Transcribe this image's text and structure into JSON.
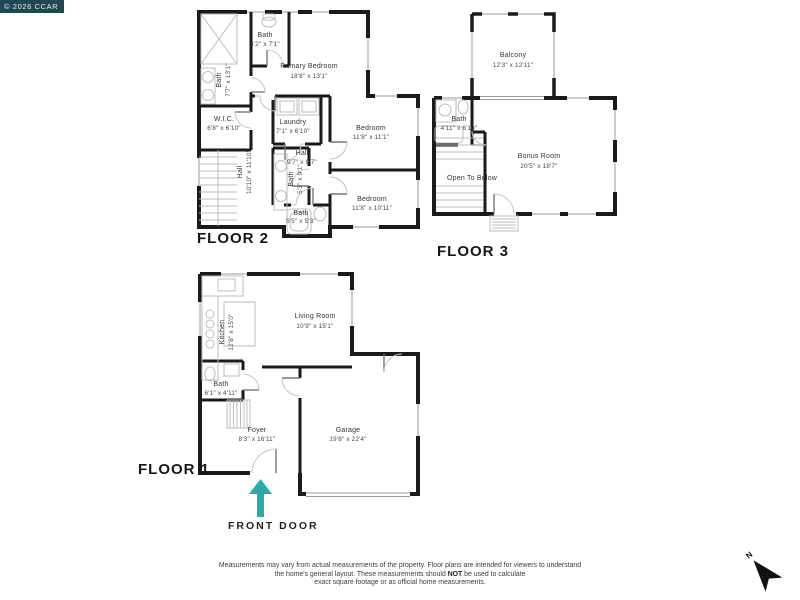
{
  "copyright": "© 2026 CCAR",
  "front_door_label": "FRONT DOOR",
  "north_label": "N",
  "colors": {
    "accent_teal": "#2aa9ae",
    "wall": "#1a1a1a",
    "copyright_bg": "#1d4752"
  },
  "floor2": {
    "label": "FLOOR 2",
    "primary_name": "Primary Bedroom",
    "primary_dims": "18'8\" x 13'1\"",
    "bath_top_name": "Bath",
    "bath_top_dims": "4'2\" x 7'1\"",
    "bath_left_name": "Bath",
    "bath_left_dims": "7'7\" x 13'1\"",
    "wic_name": "W.I.C.",
    "wic_dims": "6'8\" x 6'10\"",
    "laundry_name": "Laundry",
    "laundry_dims": "7'1\" x 6'10\"",
    "hall_left_name": "Hall",
    "hall_left_dims": "10'10\" x 11'10\"",
    "hall_name": "Hall",
    "hall_dims": "9'7\" x 9'7\"",
    "bedroom1_name": "Bedroom",
    "bedroom1_dims": "11'8\" x 11'1\"",
    "bedroom2_name": "Bedroom",
    "bedroom2_dims": "11'8\" x 10'11\"",
    "bath_mid_name": "Bath",
    "bath_mid_dims": "5'3\" x 9'1\"",
    "bath_bottom_name": "Bath",
    "bath_bottom_dims": "5'5\" x 5'3\""
  },
  "floor3": {
    "label": "FLOOR 3",
    "balcony_name": "Balcony",
    "balcony_dims": "12'3\" x 12'11\"",
    "bath_name": "Bath",
    "bath_dims": "4'11\" x 6'10\"",
    "bonus_name": "Bonus Room",
    "bonus_dims": "20'5\" x 18'7\"",
    "open_below": "Open To Below"
  },
  "floor1": {
    "label": "FLOOR 1",
    "kitchen_name": "Kitchen",
    "kitchen_dims": "12'8\" x 15'0\"",
    "living_name": "Living Room",
    "living_dims": "10'9\" x 15'1\"",
    "bath_name": "Bath",
    "bath_dims": "6'1\" x 4'11\"",
    "foyer_name": "Foyer",
    "foyer_dims": "8'3\" x 16'11\"",
    "garage_name": "Garage",
    "garage_dims": "19'8\" x 22'4\""
  },
  "disclaimer": {
    "line1": "Measurements may vary from actual measurements of the property. Floor plans are intended for viewers to understand",
    "line2_pre": "the home's general layout.  These measurements should ",
    "line2_bold": "NOT",
    "line2_post": " be used to calculate",
    "line3": "exact square footage or as official home measurements."
  }
}
